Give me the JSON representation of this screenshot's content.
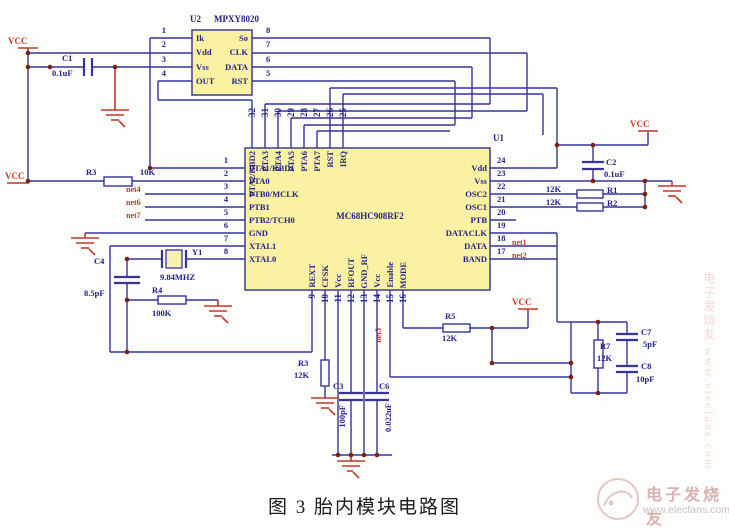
{
  "caption": "图 3  胎内模块电路图",
  "power": {
    "vcc": "VCC"
  },
  "u1": {
    "ref": "U1",
    "part": "MC68HC908RF2",
    "left_pins": [
      {
        "num": "1",
        "label": "PTA1/KBD1"
      },
      {
        "num": "2",
        "label": "PTA0"
      },
      {
        "num": "3",
        "label": "PTB0/MCLK"
      },
      {
        "num": "4",
        "label": "PTB1"
      },
      {
        "num": "5",
        "label": "PTB2/TCH0"
      },
      {
        "num": "6",
        "label": "GND"
      },
      {
        "num": "7",
        "label": "XTAL1"
      },
      {
        "num": "8",
        "label": "XTAL0"
      }
    ],
    "right_pins": [
      {
        "num": "24",
        "label": "Vdd"
      },
      {
        "num": "23",
        "label": "Vss"
      },
      {
        "num": "22",
        "label": "OSC2"
      },
      {
        "num": "21",
        "label": "OSC1"
      },
      {
        "num": "20",
        "label": "PTB"
      },
      {
        "num": "19",
        "label": "DATACLK"
      },
      {
        "num": "18",
        "label": "DATA"
      },
      {
        "num": "17",
        "label": "BAND"
      }
    ],
    "top_pins": [
      {
        "num": "32",
        "label": "PTA2/KBD2"
      },
      {
        "num": "31",
        "label": "PTA3"
      },
      {
        "num": "30",
        "label": "PTA4"
      },
      {
        "num": "29",
        "label": "PTA5"
      },
      {
        "num": "28",
        "label": "PTA6"
      },
      {
        "num": "27",
        "label": "PTA7"
      },
      {
        "num": "26",
        "label": "RST"
      },
      {
        "num": "25",
        "label": "IRQ"
      }
    ],
    "bottom_pins": [
      {
        "num": "9",
        "label": "REXT"
      },
      {
        "num": "10",
        "label": "CFSK"
      },
      {
        "num": "11",
        "label": "Vcc"
      },
      {
        "num": "12",
        "label": "RFOUT"
      },
      {
        "num": "13",
        "label": "GND_RF"
      },
      {
        "num": "14",
        "label": "Vcc"
      },
      {
        "num": "15",
        "label": "Enable"
      },
      {
        "num": "16",
        "label": "MODE"
      }
    ]
  },
  "u2": {
    "ref": "U2",
    "part": "MPXY8020",
    "left_pins": [
      {
        "num": "1",
        "label": "Ik"
      },
      {
        "num": "2",
        "label": "Vdd"
      },
      {
        "num": "3",
        "label": "Vss"
      },
      {
        "num": "4",
        "label": "OUT"
      }
    ],
    "right_pins": [
      {
        "num": "8",
        "label": "So"
      },
      {
        "num": "7",
        "label": "CLK"
      },
      {
        "num": "6",
        "label": "DATA"
      },
      {
        "num": "5",
        "label": "RST"
      }
    ]
  },
  "components": {
    "c1": {
      "ref": "C1",
      "value": "0.1uF"
    },
    "c2": {
      "ref": "C2",
      "value": "0.1uF"
    },
    "c3": {
      "ref": "C3",
      "value": "100pF"
    },
    "c4": {
      "ref": "C4",
      "value": "8.5pF"
    },
    "c6": {
      "ref": "C6",
      "value": "0.022uF"
    },
    "c7": {
      "ref": "C7",
      "value": "5pF"
    },
    "c8": {
      "ref": "C8",
      "value": "10pF"
    },
    "r1": {
      "ref": "R1",
      "value": "12K"
    },
    "r2": {
      "ref": "R2",
      "value": "12K"
    },
    "r3": {
      "ref": "R3",
      "value": "10K"
    },
    "r3b": {
      "ref": "R3",
      "value": "12K"
    },
    "r4": {
      "ref": "R4",
      "value": "100K"
    },
    "r5": {
      "ref": "R5",
      "value": "12K"
    },
    "r7": {
      "ref": "R7",
      "value": "12K"
    },
    "y1": {
      "ref": "Y1",
      "value": "9.84MHZ"
    }
  },
  "nets": {
    "left": [
      "net4",
      "net6",
      "net7"
    ],
    "right": [
      "net1",
      "net2"
    ],
    "bottom": "net5"
  },
  "watermark": {
    "brand": "电子发烧友",
    "url": "www.elecfans.com",
    "side": "电子发烧友 www.elecfans.com"
  }
}
